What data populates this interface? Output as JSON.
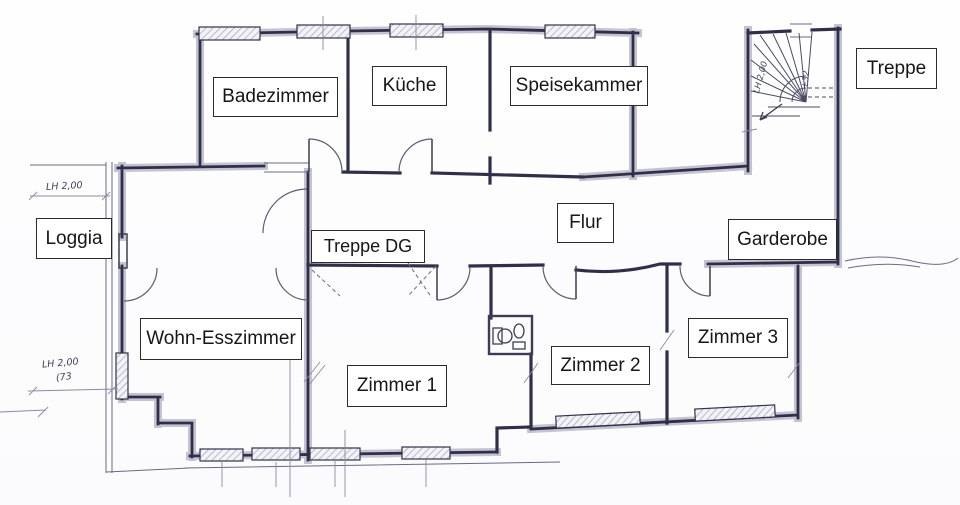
{
  "document": {
    "type": "floor-plan",
    "language": "de",
    "background": "#fcfcfd"
  },
  "colors": {
    "wall_dark": "#2f2f49",
    "wall_halo": "#c3c3d2",
    "window_hatch": "#9d9db6",
    "thin_line": "#5b5b72",
    "label_border": "#2b2b2b",
    "label_text": "#161616",
    "annotation_text": "#3d3d58"
  },
  "rooms": {
    "badezimmer": {
      "label": "Badezimmer"
    },
    "kueche": {
      "label": "Küche"
    },
    "speisekammer": {
      "label": "Speisekammer"
    },
    "treppe": {
      "label": "Treppe"
    },
    "loggia": {
      "label": "Loggia"
    },
    "treppe_dg": {
      "label": "Treppe DG"
    },
    "flur": {
      "label": "Flur"
    },
    "garderobe": {
      "label": "Garderobe"
    },
    "wohn_esszimmer": {
      "label": "Wohn-Esszimmer"
    },
    "zimmer_1": {
      "label": "Zimmer 1"
    },
    "zimmer_2": {
      "label": "Zimmer 2"
    },
    "zimmer_3": {
      "label": "Zimmer 3"
    }
  },
  "annotations": {
    "lh_top": "LH 2,00",
    "lh_bottom": "LH 2,00",
    "lh_bottom_note": "(73",
    "stairs_lh": "LH 2,00",
    "stairs_step": "+32"
  }
}
